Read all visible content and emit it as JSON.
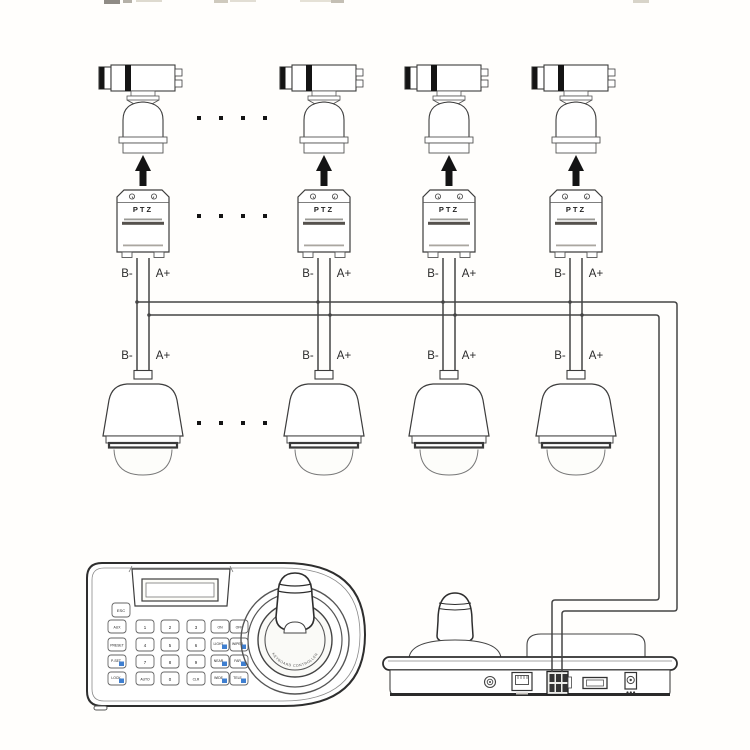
{
  "colors": {
    "background": "#fffefc",
    "line": "#454545",
    "ink": "#141414",
    "key_blue": "#3f7fd0"
  },
  "columns": [
    {
      "ptz": "PTZ",
      "b_top": "B-",
      "a_top": "A+",
      "b_bottom": "B-",
      "a_bottom": "A+"
    },
    {
      "ptz": "PTZ",
      "b_top": "B-",
      "a_top": "A+",
      "b_bottom": "B-",
      "a_bottom": "A+"
    },
    {
      "ptz": "PTZ",
      "b_top": "B-",
      "a_top": "A+",
      "b_bottom": "B-",
      "a_bottom": "A+"
    },
    {
      "ptz": "PTZ",
      "b_top": "B-",
      "a_top": "A+",
      "b_bottom": "B-",
      "a_bottom": "A+"
    }
  ],
  "keyboard": {
    "esc": "ESC",
    "keys": [
      "AUX",
      "1",
      "2",
      "3",
      "ON",
      "OFF",
      "PRESET",
      "4",
      "5",
      "6",
      "LIGHT",
      "WIPER",
      "P-SET",
      "7",
      "8",
      "9",
      "NEAR",
      "FAR",
      "LOCK",
      "AUTO",
      "0",
      "CLR",
      "WIDE",
      "TELE"
    ],
    "ring_text": "KEYBOARD CONTROLLER"
  }
}
